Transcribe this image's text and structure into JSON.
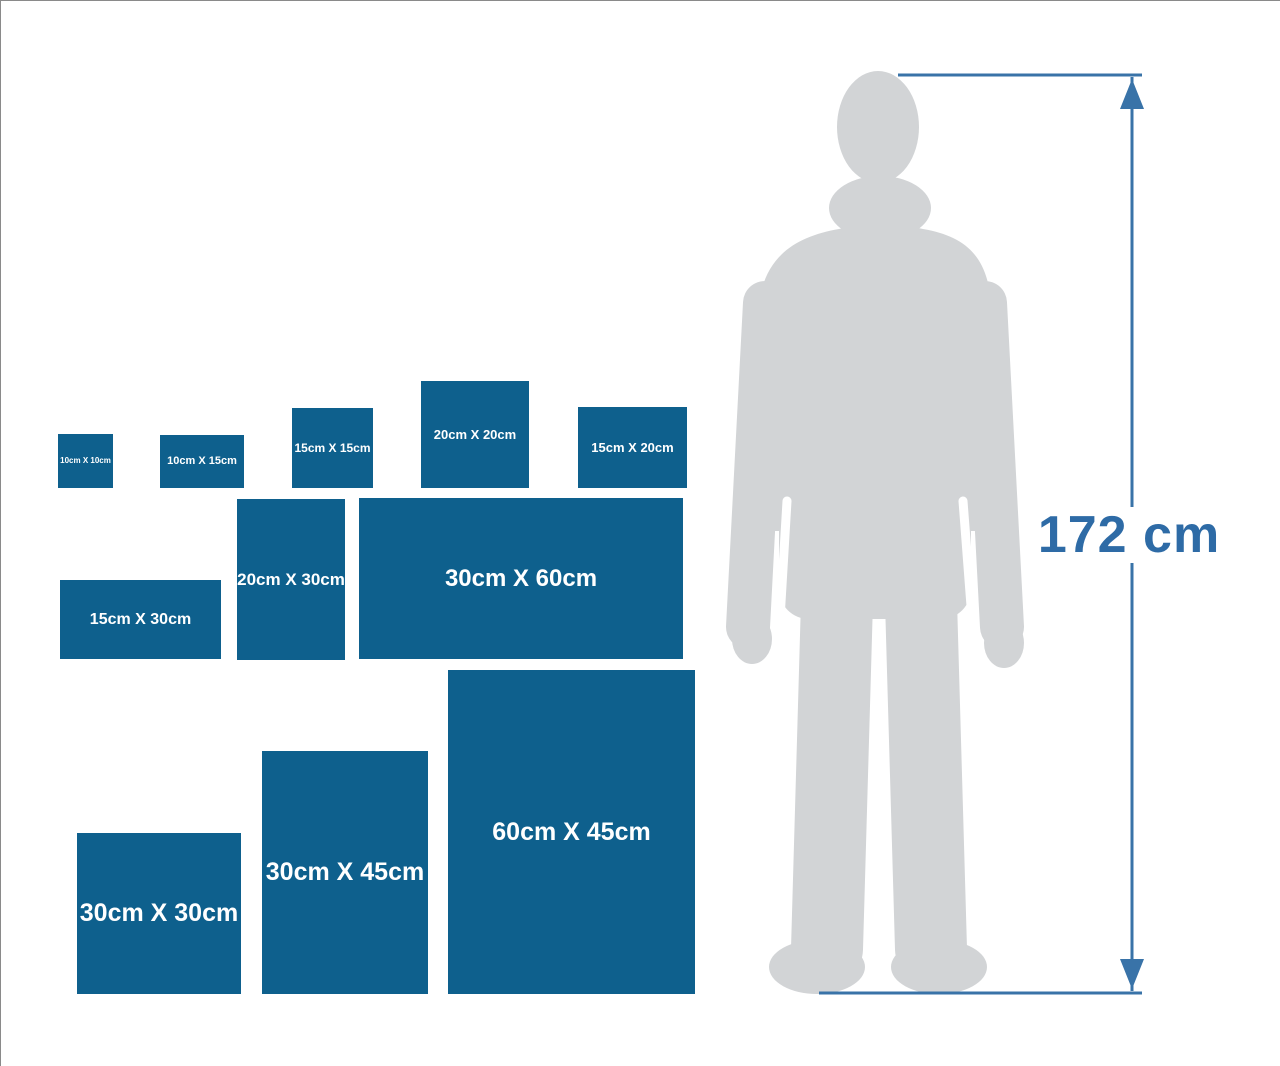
{
  "figure": {
    "height_label": "172 cm"
  },
  "colors": {
    "panel_blue": "#0e608d",
    "label_white": "#ffffff",
    "measure_line": "#3973a8",
    "measure_text": "#2e6ba6",
    "silhouette_gray": "#d2d4d6",
    "frame_gray": "#8a8a8a"
  },
  "panels": [
    {
      "label": "10cm X 10cm",
      "size_cm": "10 x 10",
      "x": 57,
      "y": 433,
      "w": 55,
      "h": 54,
      "font": 8
    },
    {
      "label": "10cm X 15cm",
      "size_cm": "10 x 15",
      "x": 159,
      "y": 434,
      "w": 84,
      "h": 53,
      "font": 11
    },
    {
      "label": "15cm X 15cm",
      "size_cm": "15 x 15",
      "x": 291,
      "y": 407,
      "w": 81,
      "h": 80,
      "font": 12
    },
    {
      "label": "20cm X 20cm",
      "size_cm": "20 x 20",
      "x": 420,
      "y": 380,
      "w": 108,
      "h": 107,
      "font": 13
    },
    {
      "label": "15cm X 20cm",
      "size_cm": "15 x 20",
      "x": 577,
      "y": 406,
      "w": 109,
      "h": 81,
      "font": 13
    },
    {
      "label": "15cm X 30cm",
      "size_cm": "15 x 30",
      "x": 59,
      "y": 579,
      "w": 161,
      "h": 79,
      "font": 16
    },
    {
      "label": "20cm X 30cm",
      "size_cm": "20 x 30",
      "x": 236,
      "y": 498,
      "w": 108,
      "h": 161,
      "font": 17
    },
    {
      "label": "30cm X 60cm",
      "size_cm": "30 x 60",
      "x": 358,
      "y": 497,
      "w": 324,
      "h": 161,
      "font": 24
    },
    {
      "label": "30cm X 30cm",
      "size_cm": "30 x 30",
      "x": 76,
      "y": 832,
      "w": 164,
      "h": 161,
      "font": 25
    },
    {
      "label": "30cm X 45cm",
      "size_cm": "30 x 45",
      "x": 261,
      "y": 750,
      "w": 166,
      "h": 243,
      "font": 25
    },
    {
      "label": "60cm X 45cm",
      "size_cm": "60 x 45",
      "x": 447,
      "y": 669,
      "w": 247,
      "h": 324,
      "font": 25
    }
  ],
  "chart_data": {
    "type": "size-comparison",
    "reference_object": "standing man silhouette",
    "reference_height_label": "172 cm",
    "reference_height_cm": 172,
    "panel_sizes_cm": [
      [
        10,
        10
      ],
      [
        10,
        15
      ],
      [
        15,
        15
      ],
      [
        20,
        20
      ],
      [
        15,
        20
      ],
      [
        15,
        30
      ],
      [
        20,
        30
      ],
      [
        30,
        60
      ],
      [
        30,
        30
      ],
      [
        30,
        45
      ],
      [
        60,
        45
      ]
    ]
  }
}
